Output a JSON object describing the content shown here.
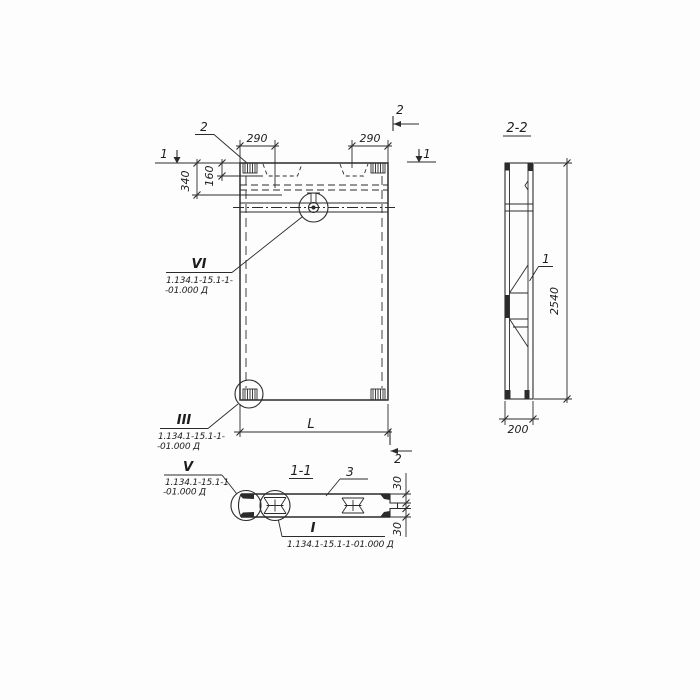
{
  "front_view": {
    "dims": {
      "top_left": "290",
      "top_right": "290",
      "edge_160": "160",
      "edge_340": "340",
      "length": "L"
    },
    "marks": {
      "sec1_left": "1",
      "sec1_right": "1",
      "sec2_top": "2",
      "sec2_bottom": "2",
      "embed_leader": "2"
    },
    "details": {
      "vi": {
        "numeral": "VI",
        "ref1": "1.134.1-15.1-1-",
        "ref2": "-01.000 Д"
      },
      "iii": {
        "numeral": "III",
        "ref1": "1.134.1-15.1-1-",
        "ref2": "-01.000 Д"
      }
    }
  },
  "section_1_1": {
    "title": "1-1",
    "callout_3": "3",
    "dims": {
      "step_top": "30",
      "step_bottom": "30"
    },
    "details": {
      "v": {
        "numeral": "V",
        "ref1": "1.134.1-15.1-1",
        "ref2": "-01.000 Д"
      },
      "i": {
        "numeral": "I",
        "ref": "1.134.1-15.1-1-01.000 Д"
      }
    }
  },
  "section_2_2": {
    "title": "2-2",
    "dims": {
      "height": "2540",
      "width": "200"
    },
    "callout_1": "1"
  }
}
